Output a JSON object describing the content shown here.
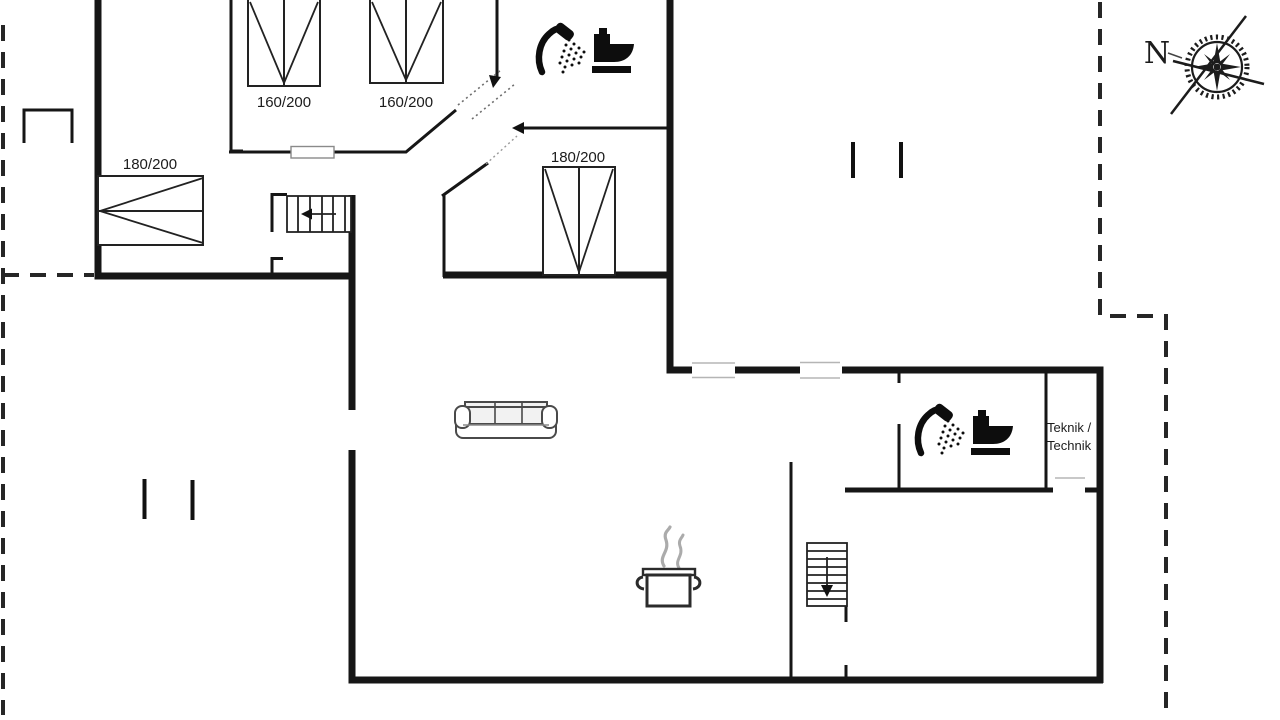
{
  "labels": {
    "bed_left": "180/200",
    "bed_top_first": "160/200",
    "bed_top_second": "160/200",
    "bed_middle": "180/200",
    "utility_line1": "Teknik /",
    "utility_line2": "Technik",
    "compass_north": "N"
  },
  "icons": [
    "compass-rose-icon",
    "shower-icon",
    "toilet-icon",
    "sofa-icon",
    "cooking-pot-icon",
    "stairs-up-icon",
    "stairs-down-icon"
  ],
  "colors": {
    "wall": "#161616",
    "label_text": "#1c1c1c",
    "boundary_dash": "#262626",
    "window_line": "#b5b5b5",
    "door_leaf": "#8a8a8a",
    "steam": "#ababab",
    "background": "#ffffff"
  }
}
